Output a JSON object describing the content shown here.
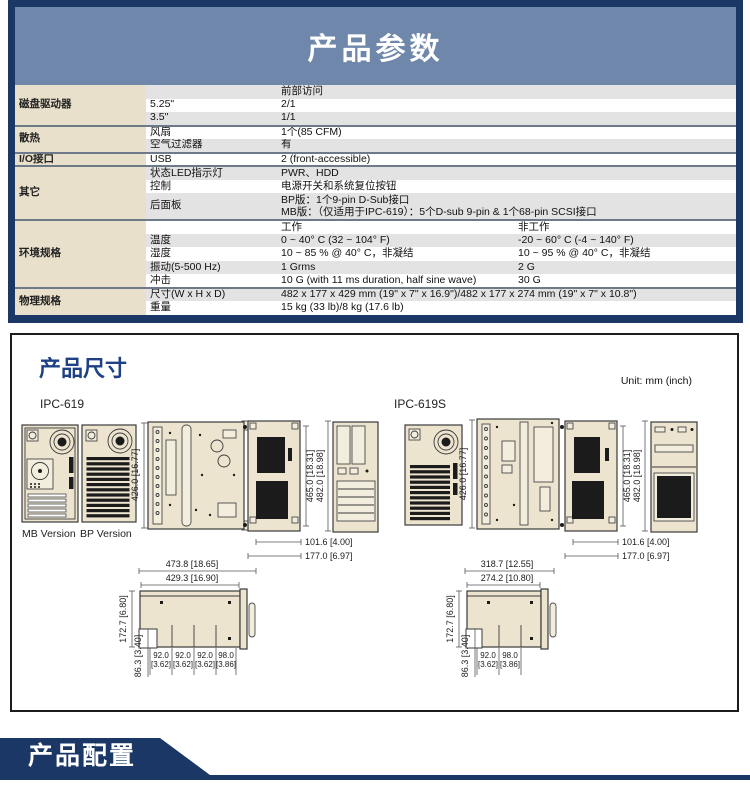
{
  "colors": {
    "navy": "#1a3765",
    "header_blue": "#6e87ab",
    "category_beige": "#e8e0cb",
    "stripe_gray": "#e3e3e3",
    "drawing_fill": "#ece4cf",
    "title_blue": "#1e4185"
  },
  "params": {
    "title": "产品参数",
    "groups": [
      {
        "category": "磁盘驱动器",
        "rows": [
          {
            "sub": "",
            "value": "前部访问"
          },
          {
            "sub": "5.25\"",
            "value": "2/1"
          },
          {
            "sub": "3.5\"",
            "value": "1/1"
          }
        ]
      },
      {
        "category": "散热",
        "rows": [
          {
            "sub": "风扇",
            "value": "1个(85 CFM)"
          },
          {
            "sub": "空气过滤器",
            "value": "有"
          }
        ]
      },
      {
        "category": "I/O接口",
        "rows": [
          {
            "sub": "USB",
            "value": "2 (front-accessible)"
          }
        ]
      },
      {
        "category": "其它",
        "rows": [
          {
            "sub": "状态LED指示灯",
            "value": "PWR、HDD"
          },
          {
            "sub": "控制",
            "value": "电源开关和系统复位按钮"
          },
          {
            "sub": "后面板",
            "lines": [
              "BP版：1个9-pin D-Sub接口",
              "MB版：（仅适用于IPC-619）：5个D-sub 9-pin & 1个68-pin SCSI接口"
            ]
          }
        ]
      },
      {
        "category": "环境规格",
        "rows": [
          {
            "sub": "",
            "value": "工作",
            "value2": "非工作"
          },
          {
            "sub": "温度",
            "value": "0 ~ 40° C (32 ~ 104° F)",
            "value2": "-20 ~ 60° C (-4 ~ 140° F)"
          },
          {
            "sub": "湿度",
            "value": "10 ~ 85 % @ 40° C，非凝结",
            "value2": "10 ~ 95 % @ 40° C，非凝结"
          },
          {
            "sub": "振动(5-500 Hz)",
            "value": "1 Grms",
            "value2": "2 G"
          },
          {
            "sub": "冲击",
            "value": "10 G (with 11 ms duration, half sine wave)",
            "value2": "30 G"
          }
        ]
      },
      {
        "category": "物理规格",
        "rows": [
          {
            "sub": "尺寸(W x H x D)",
            "value": "482 x 177 x 429 mm (19\" x 7\" x 16.9\")/482 x 177 x 274 mm (19\" x 7\" x 10.8\")"
          },
          {
            "sub": "重量",
            "value": "15 kg (33 lb)/8 kg (17.6 lb)"
          }
        ]
      }
    ]
  },
  "dims": {
    "title": "产品尺寸",
    "unit": "Unit: mm (inch)",
    "ipc619": {
      "model": "IPC-619",
      "mb_label": "MB Version",
      "bp_label": "BP Version",
      "depth": "426.0 [16.77]",
      "height_inner": "465.0 [18.31]",
      "height_outer": "482.0 [18.98]",
      "width_inner": "101.6 [4.00]",
      "width_outer": "177.0 [6.97]",
      "profile_outer": "473.8 [18.65]",
      "profile_inner": "429.3 [16.90]",
      "front_h": "172.7 [6.80]",
      "foot_h": "86.3 [3.40]",
      "segs": [
        {
          "mm": "92.0",
          "in": "[3.62]"
        },
        {
          "mm": "92.0",
          "in": "[3.62]"
        },
        {
          "mm": "92.0",
          "in": "[3.62]"
        },
        {
          "mm": "98.0",
          "in": "[3.86]"
        }
      ]
    },
    "ipc619s": {
      "model": "IPC-619S",
      "depth": "426.0 [16.77]",
      "height_inner": "465.0 [18.31]",
      "height_outer": "482.0 [18.98]",
      "width_inner": "101.6 [4.00]",
      "width_outer": "177.0 [6.97]",
      "profile_outer": "318.7 [12.55]",
      "profile_inner": "274.2 [10.80]",
      "front_h": "172.7 [6.80]",
      "foot_h": "86.3 [3.40]",
      "segs": [
        {
          "mm": "92.0",
          "in": "[3.62]"
        },
        {
          "mm": "98.0",
          "in": "[3.86]"
        }
      ]
    }
  },
  "config": {
    "title": "产品配置"
  }
}
